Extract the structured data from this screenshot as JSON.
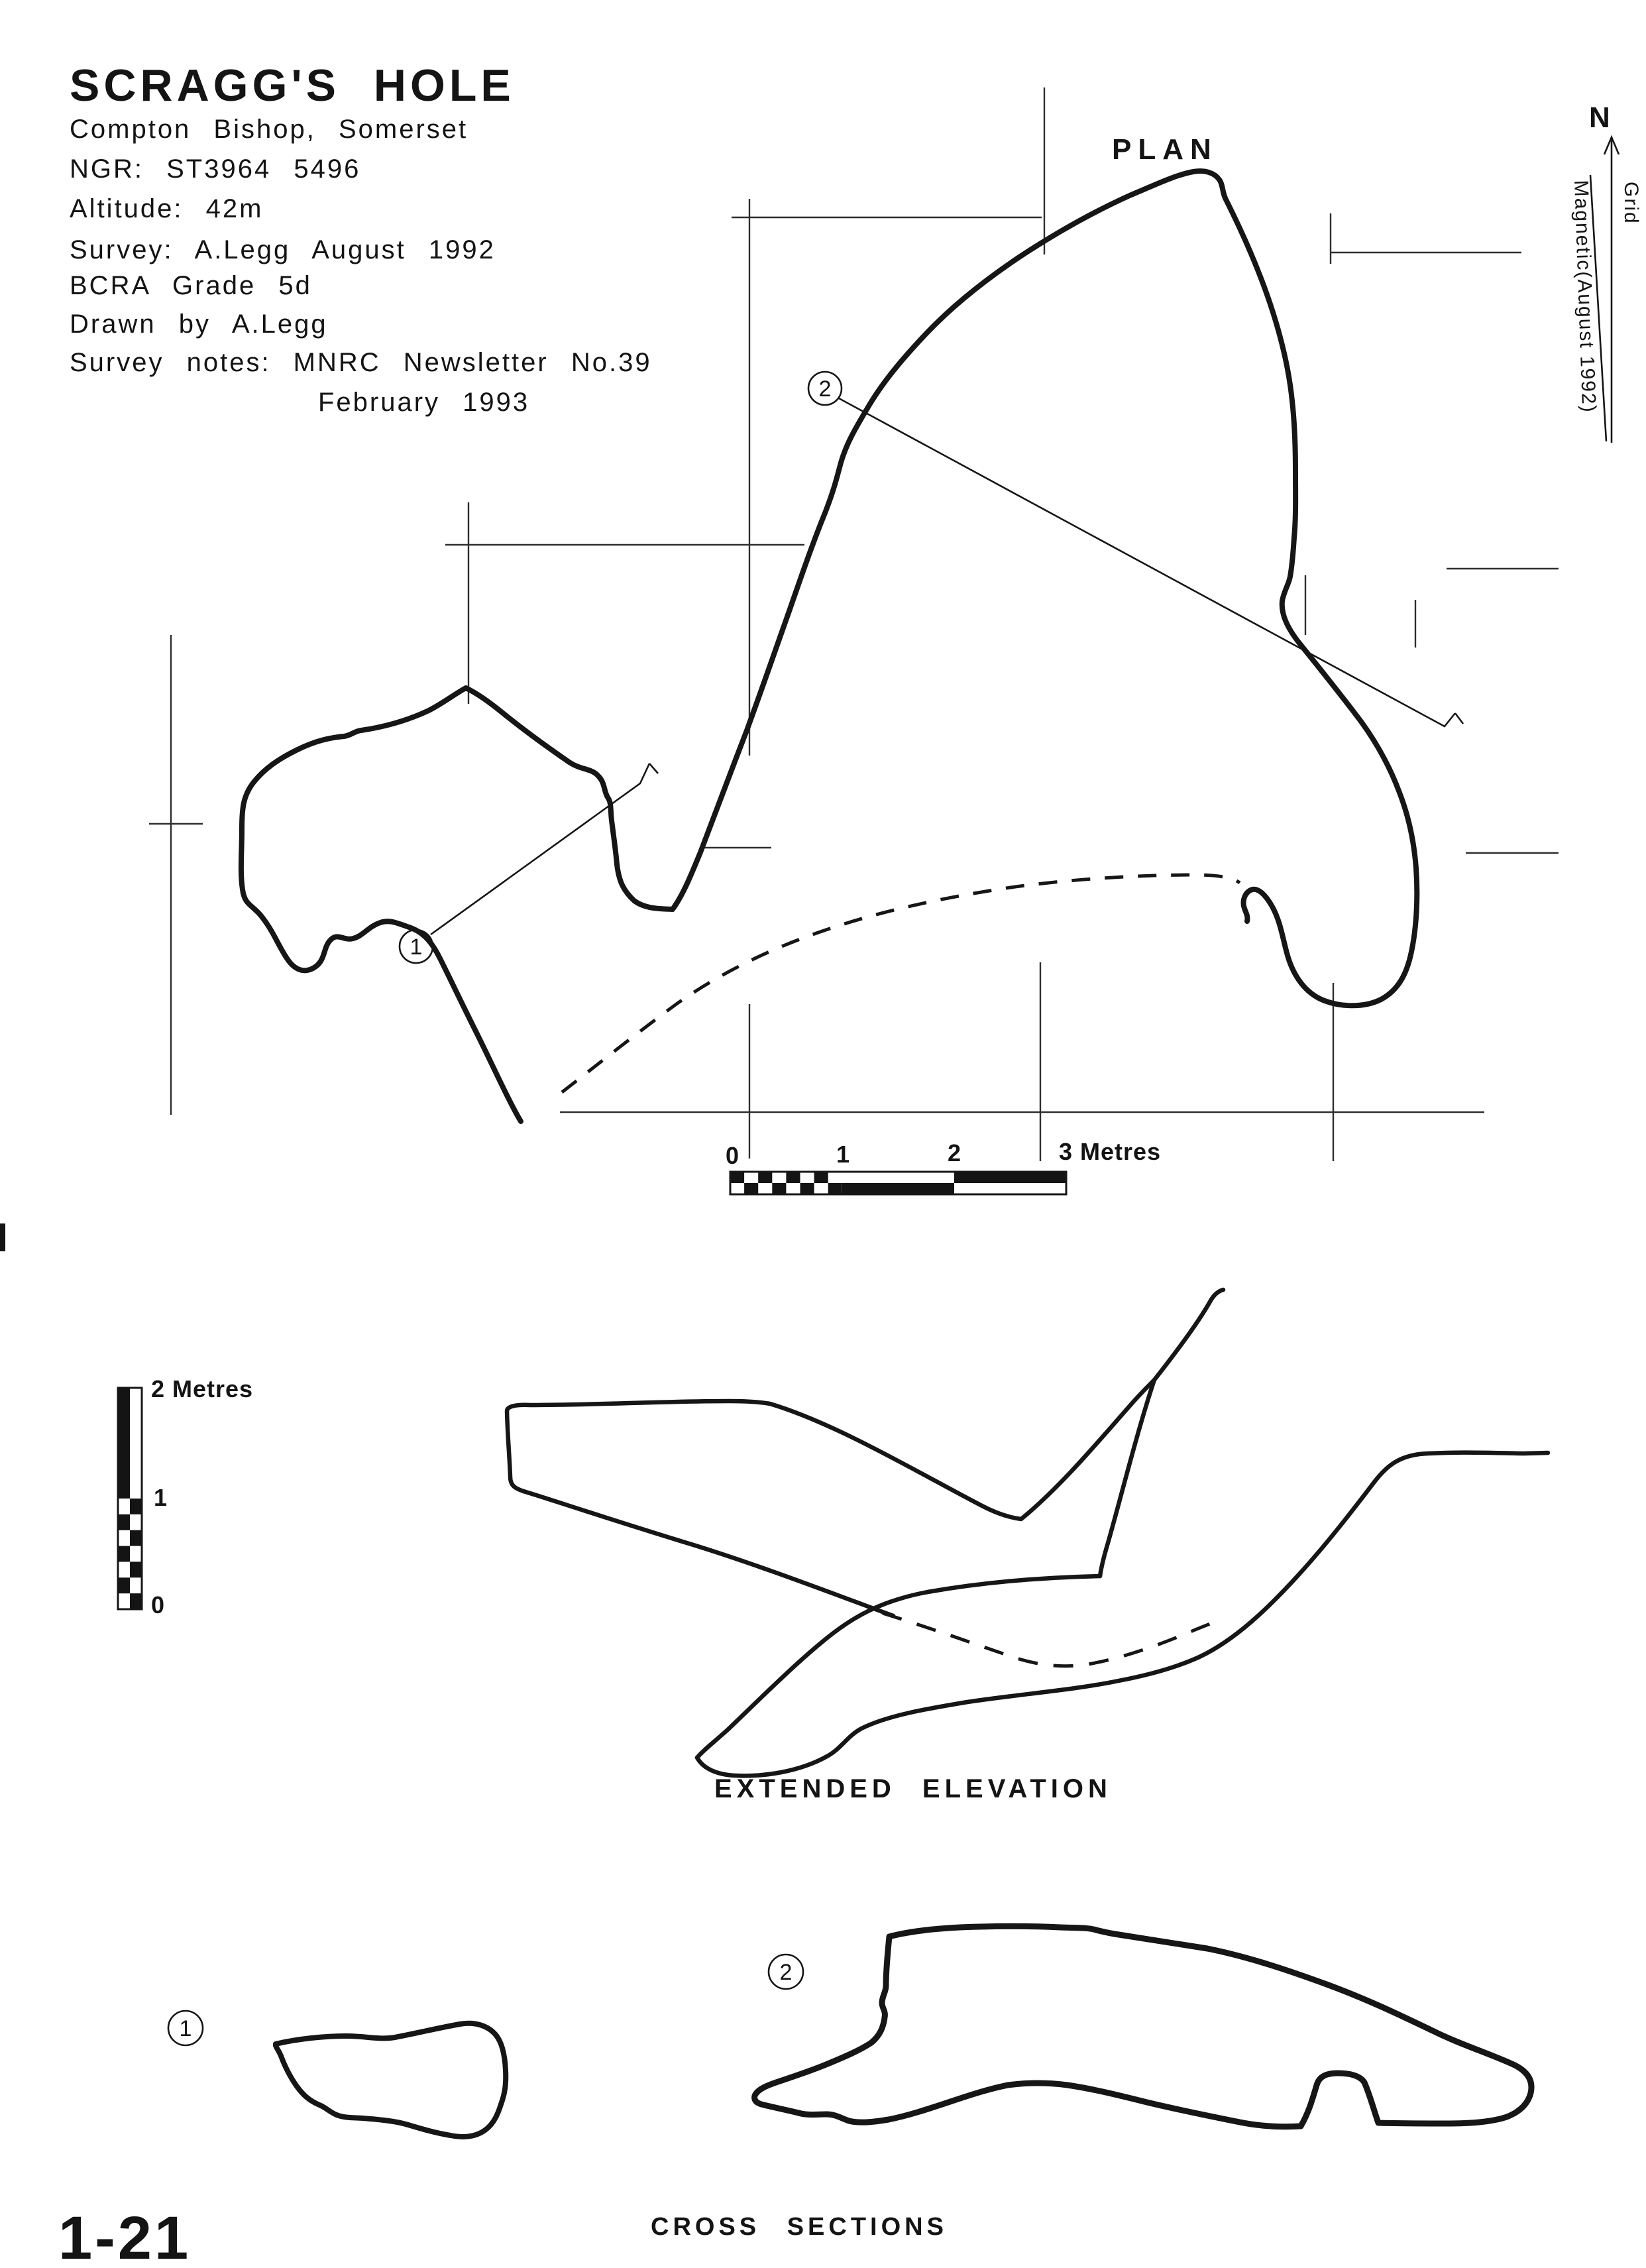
{
  "title_block": {
    "title": "SCRAGG'S HOLE",
    "location": "Compton Bishop, Somerset",
    "ngr": "NGR: ST3964 5496",
    "altitude": "Altitude: 42m",
    "survey": "Survey: A.Legg August 1992",
    "grade": "BCRA Grade 5d",
    "drawn": "Drawn by A.Legg",
    "notes_line1": "Survey notes: MNRC Newsletter No.39",
    "notes_line2": "February 1993"
  },
  "plan": {
    "label": "PLAN",
    "north_letter": "N",
    "north_grid_label": "Grid",
    "north_magnetic_label": "Magnetic(August 1992)",
    "section_marker_1": "1",
    "section_marker_2": "2"
  },
  "scale_bar_horizontal": {
    "tick_0": "0",
    "tick_1": "1",
    "tick_2": "2",
    "tick_3": "3 Metres"
  },
  "scale_bar_vertical": {
    "top_label": "2 Metres",
    "middle_label": "1",
    "bottom_label": "0"
  },
  "elevation": {
    "label": "EXTENDED ELEVATION"
  },
  "cross_sections": {
    "label": "CROSS SECTIONS",
    "section_marker_1": "1",
    "section_marker_2": "2"
  },
  "page": {
    "number": "1-21"
  },
  "colors": {
    "ink": "#161616",
    "paper": "#ffffff"
  }
}
